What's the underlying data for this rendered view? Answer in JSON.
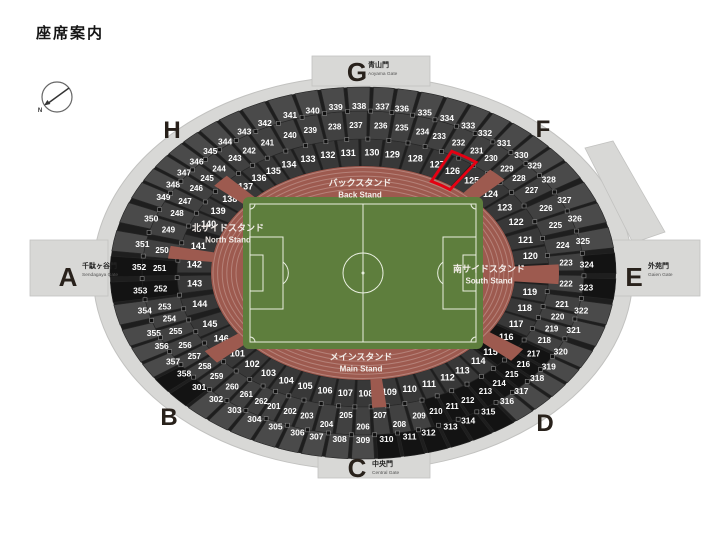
{
  "title": "座席案内",
  "compass": {
    "label": "N"
  },
  "highlighted_section": "126",
  "colors": {
    "background": "#ffffff",
    "concourse": "#d8d8d6",
    "concourse_edge": "#c2c2c0",
    "seating_base": "#1e1e1e",
    "band_inner": "#383838",
    "band_middle": "#414141",
    "band_outer": "#4a4a4a",
    "seating_black": "#131313",
    "track": "#9d5a4f",
    "field": "#5e7e3d",
    "field_line": "#e9efe0",
    "highlight": "#e60012",
    "label_text": "#ffffff",
    "gate_letter": "#28211b"
  },
  "gates": [
    {
      "letter": "A",
      "name_jp": "千駄ヶ谷門",
      "name_en": "Sendagaya Gate"
    },
    {
      "letter": "B",
      "name_jp": "",
      "name_en": ""
    },
    {
      "letter": "C",
      "name_jp": "中央門",
      "name_en": "Central Gate"
    },
    {
      "letter": "D",
      "name_jp": "",
      "name_en": ""
    },
    {
      "letter": "E",
      "name_jp": "外苑門",
      "name_en": "Gaien Gate"
    },
    {
      "letter": "F",
      "name_jp": "",
      "name_en": ""
    },
    {
      "letter": "G",
      "name_jp": "青山門",
      "name_en": "Aoyama Gate"
    },
    {
      "letter": "H",
      "name_jp": "",
      "name_en": ""
    }
  ],
  "stands": [
    {
      "id": "back",
      "name_jp": "バックスタンド",
      "name_en": "Back Stand"
    },
    {
      "id": "north",
      "name_jp": "北サイドスタンド",
      "name_en": "North Stand"
    },
    {
      "id": "south",
      "name_jp": "南サイドスタンド",
      "name_en": "South Stand"
    },
    {
      "id": "main",
      "name_jp": "メインスタンド",
      "name_en": "Main Stand"
    }
  ],
  "rings": [
    {
      "name": "inner",
      "sections": [
        [
          "101",
          138
        ],
        [
          "102",
          131
        ],
        [
          "103",
          124
        ],
        [
          "104",
          117
        ],
        [
          "105",
          110
        ],
        [
          "106",
          103
        ],
        [
          "107",
          96
        ],
        [
          "108",
          89
        ],
        [
          "109",
          81
        ],
        [
          "110",
          74
        ],
        [
          "111",
          67
        ],
        [
          "112",
          60
        ],
        [
          "113",
          54
        ],
        [
          "114",
          47
        ],
        [
          "115",
          41
        ],
        [
          "116",
          32
        ],
        [
          "117",
          25
        ],
        [
          "118",
          17
        ],
        [
          "119",
          9
        ],
        [
          "120",
          -8
        ],
        [
          "121",
          -16
        ],
        [
          "122",
          -25
        ],
        [
          "123",
          -33
        ],
        [
          "124",
          -41
        ],
        [
          "125",
          -50
        ],
        [
          "126",
          -58
        ],
        [
          "127",
          -64
        ],
        [
          "128",
          -72
        ],
        [
          "129",
          -80
        ],
        [
          "130",
          -87
        ],
        [
          "131",
          -95
        ],
        [
          "132",
          -102
        ],
        [
          "133",
          -109
        ],
        [
          "134",
          -116
        ],
        [
          "135",
          -122
        ],
        [
          "136",
          -128
        ],
        [
          "137",
          -134
        ],
        [
          "138",
          -142
        ],
        [
          "139",
          -149
        ],
        [
          "140",
          -156
        ],
        [
          "141",
          -167
        ],
        [
          "142",
          -176
        ],
        [
          "143",
          -185
        ],
        [
          "144",
          -195
        ],
        [
          "145",
          -205
        ],
        [
          "146",
          -213
        ]
      ]
    },
    {
      "name": "middle",
      "sections": [
        [
          "201",
          116
        ],
        [
          "202",
          111
        ],
        [
          "203",
          106
        ],
        [
          "204",
          100
        ],
        [
          "205",
          95
        ],
        [
          "206",
          90
        ],
        [
          "207",
          85
        ],
        [
          "208",
          80
        ],
        [
          "209",
          74
        ],
        [
          "210",
          69
        ],
        [
          "211",
          64
        ],
        [
          "212",
          59
        ],
        [
          "213",
          53
        ],
        [
          "214",
          48
        ],
        [
          "215",
          43
        ],
        [
          "216",
          38
        ],
        [
          "217",
          33
        ],
        [
          "218",
          27
        ],
        [
          "219",
          22
        ],
        [
          "220",
          17
        ],
        [
          "221",
          12
        ],
        [
          "222",
          4
        ],
        [
          "223",
          -4
        ],
        [
          "224",
          -11
        ],
        [
          "225",
          -19
        ],
        [
          "226",
          -26
        ],
        [
          "227",
          -34
        ],
        [
          "228",
          -40
        ],
        [
          "229",
          -45
        ],
        [
          "230",
          -51
        ],
        [
          "231",
          -56
        ],
        [
          "232",
          -62
        ],
        [
          "233",
          -68
        ],
        [
          "234",
          -73
        ],
        [
          "235",
          -79
        ],
        [
          "236",
          -85
        ],
        [
          "237",
          -92
        ],
        [
          "238",
          -98
        ],
        [
          "239",
          -105
        ],
        [
          "240",
          -111
        ],
        [
          "241",
          -118
        ],
        [
          "242",
          -124
        ],
        [
          "243",
          -129
        ],
        [
          "244",
          -135
        ],
        [
          "245",
          -140
        ],
        [
          "246",
          -145
        ],
        [
          "247",
          -151
        ],
        [
          "248",
          -156
        ],
        [
          "249",
          -163
        ],
        [
          "250",
          -171
        ],
        [
          "251",
          -178
        ],
        [
          "252",
          -186
        ],
        [
          "253",
          -193
        ],
        [
          "254",
          -198
        ],
        [
          "255",
          -203
        ],
        [
          "256",
          -209
        ],
        [
          "257",
          -214
        ],
        [
          "258",
          -219
        ],
        [
          "259",
          -224
        ],
        [
          "260",
          -230
        ],
        [
          "261",
          -235
        ],
        [
          "262",
          -240
        ]
      ]
    },
    {
      "name": "outer",
      "sections": [
        [
          "301",
          137
        ],
        [
          "302",
          131
        ],
        [
          "303",
          125
        ],
        [
          "304",
          119
        ],
        [
          "305",
          113
        ],
        [
          "306",
          107
        ],
        [
          "307",
          102
        ],
        [
          "308",
          96
        ],
        [
          "309",
          90
        ],
        [
          "310",
          84
        ],
        [
          "311",
          78
        ],
        [
          "312",
          73
        ],
        [
          "313",
          67
        ],
        [
          "314",
          62
        ],
        [
          "315",
          56
        ],
        [
          "316",
          50
        ],
        [
          "317",
          45
        ],
        [
          "318",
          39
        ],
        [
          "319",
          34
        ],
        [
          "320",
          28
        ],
        [
          "321",
          20
        ],
        [
          "322",
          13
        ],
        [
          "323",
          5
        ],
        [
          "324",
          -3
        ],
        [
          "325",
          -11
        ],
        [
          "326",
          -19
        ],
        [
          "327",
          -26
        ],
        [
          "328",
          -34
        ],
        [
          "329",
          -40
        ],
        [
          "330",
          -45
        ],
        [
          "331",
          -51
        ],
        [
          "332",
          -57
        ],
        [
          "333",
          -62
        ],
        [
          "334",
          -68
        ],
        [
          "335",
          -74
        ],
        [
          "336",
          -80
        ],
        [
          "337",
          -85
        ],
        [
          "338",
          -91
        ],
        [
          "339",
          -97
        ],
        [
          "340",
          -103
        ],
        [
          "341",
          -109
        ],
        [
          "342",
          -116
        ],
        [
          "343",
          -122
        ],
        [
          "344",
          -128
        ],
        [
          "345",
          -133
        ],
        [
          "346",
          -138
        ],
        [
          "347",
          -143
        ],
        [
          "348",
          -148
        ],
        [
          "349",
          -153
        ],
        [
          "350",
          -161
        ],
        [
          "351",
          -170
        ],
        [
          "352",
          -178
        ],
        [
          "353",
          -186
        ],
        [
          "354",
          -193
        ],
        [
          "355",
          -201
        ],
        [
          "356",
          -206
        ],
        [
          "357",
          -212
        ],
        [
          "358",
          -217
        ]
      ]
    }
  ],
  "black_sections": [
    "115",
    "116",
    "210",
    "211",
    "212",
    "213",
    "214",
    "215",
    "216",
    "217",
    "251",
    "252",
    "301",
    "310",
    "311",
    "312",
    "313",
    "314",
    "315",
    "323",
    "324",
    "352",
    "353",
    "358"
  ]
}
